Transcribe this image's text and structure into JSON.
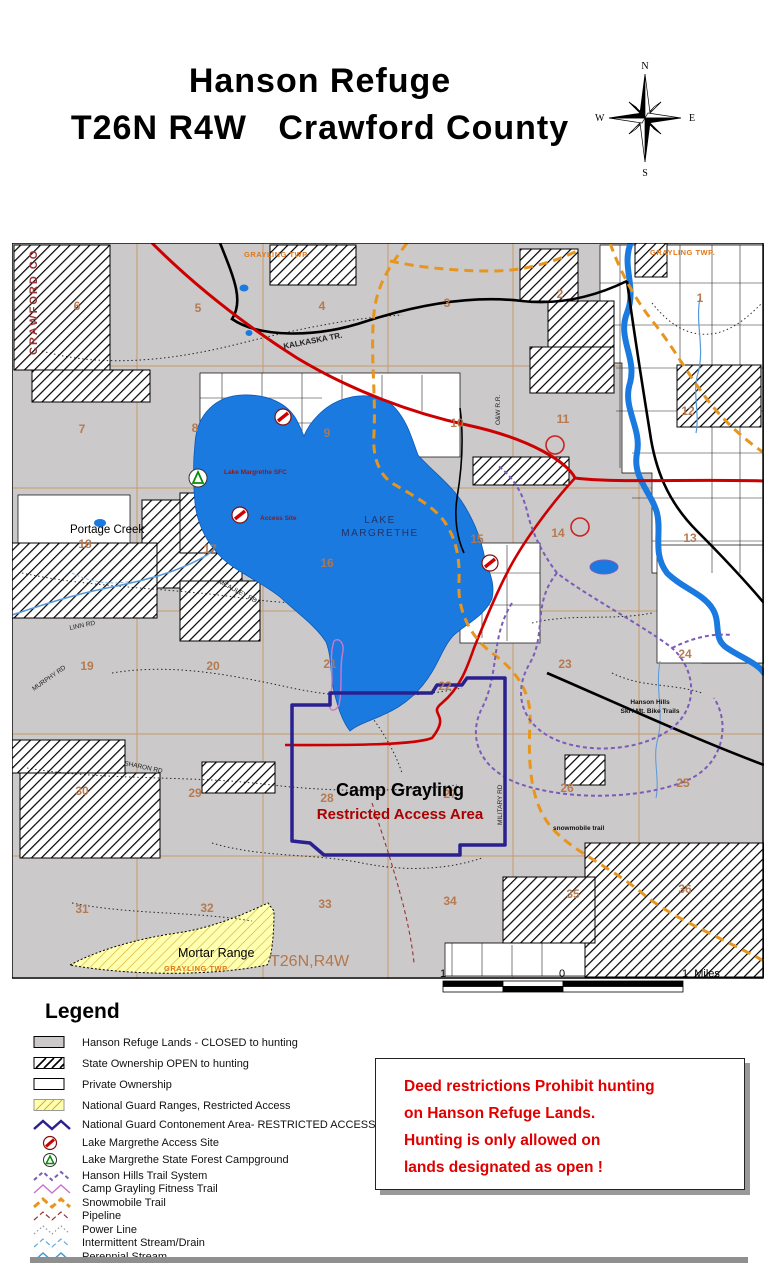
{
  "title": {
    "line1": "Hanson Refuge",
    "line2": "T26N R4W   Crawford County"
  },
  "compass": {
    "n": "N",
    "s": "S",
    "e": "E",
    "w": "W"
  },
  "map": {
    "labels": {
      "crawford_co": "CRAWFORD CO",
      "grayling_twp": "GRAYLING TWP.",
      "kalkaska_tr": "KALKASKA TR.",
      "portage_creek": "Portage Creek",
      "lake_sfc": "Lake Margrethe SFC",
      "access_site": "Access Site",
      "lake_line1": "LAKE",
      "lake_line2": "MARGRETHE",
      "mcauley_rd": "MCAULEY RD.",
      "linn_rd": "LINN RD",
      "murphy_rd": "MURPHY RD",
      "sharon_rd": "SHARON RD",
      "military_rd": "MILITARY RD",
      "ow_rr": "O&W R.R.",
      "camp_grayling": "Camp Grayling",
      "restricted": "Restricted Access Area",
      "hanson_hills_1": "Hanson Hills",
      "hanson_hills_2": "Ski / Mt. Bike Trails",
      "snowmobile": "snowmobile trail",
      "mortar_range": "Mortar Range",
      "township_range": "T26N,R4W"
    },
    "sections": [
      {
        "n": "6",
        "x": 65,
        "y": 67
      },
      {
        "n": "5",
        "x": 186,
        "y": 69
      },
      {
        "n": "4",
        "x": 310,
        "y": 67
      },
      {
        "n": "3",
        "x": 435,
        "y": 64
      },
      {
        "n": "2",
        "x": 548,
        "y": 55
      },
      {
        "n": "1",
        "x": 688,
        "y": 59
      },
      {
        "n": "7",
        "x": 70,
        "y": 190
      },
      {
        "n": "8",
        "x": 183,
        "y": 189
      },
      {
        "n": "9",
        "x": 315,
        "y": 194
      },
      {
        "n": "10",
        "x": 445,
        "y": 184
      },
      {
        "n": "11",
        "x": 551,
        "y": 180
      },
      {
        "n": "12",
        "x": 676,
        "y": 172
      },
      {
        "n": "18",
        "x": 73,
        "y": 305
      },
      {
        "n": "17",
        "x": 198,
        "y": 310
      },
      {
        "n": "16",
        "x": 315,
        "y": 324
      },
      {
        "n": "15",
        "x": 465,
        "y": 300
      },
      {
        "n": "14",
        "x": 546,
        "y": 294
      },
      {
        "n": "13",
        "x": 678,
        "y": 299
      },
      {
        "n": "19",
        "x": 75,
        "y": 427
      },
      {
        "n": "20",
        "x": 201,
        "y": 427
      },
      {
        "n": "21",
        "x": 318,
        "y": 425
      },
      {
        "n": "22",
        "x": 433,
        "y": 447
      },
      {
        "n": "23",
        "x": 553,
        "y": 425
      },
      {
        "n": "24",
        "x": 673,
        "y": 415
      },
      {
        "n": "30",
        "x": 70,
        "y": 552
      },
      {
        "n": "29",
        "x": 183,
        "y": 554
      },
      {
        "n": "28",
        "x": 315,
        "y": 559
      },
      {
        "n": "27",
        "x": 438,
        "y": 555
      },
      {
        "n": "26",
        "x": 555,
        "y": 549
      },
      {
        "n": "25",
        "x": 671,
        "y": 544
      },
      {
        "n": "31",
        "x": 70,
        "y": 670
      },
      {
        "n": "32",
        "x": 195,
        "y": 669
      },
      {
        "n": "33",
        "x": 313,
        "y": 665
      },
      {
        "n": "34",
        "x": 438,
        "y": 662
      },
      {
        "n": "35",
        "x": 561,
        "y": 655
      },
      {
        "n": "36",
        "x": 673,
        "y": 650
      }
    ]
  },
  "scalebar": {
    "left": "1",
    "zero": "0",
    "right": "1  Miles"
  },
  "legend": {
    "heading": "Legend",
    "items": [
      {
        "label": "Hanson Refuge Lands - CLOSED to hunting",
        "type": "swatch",
        "fill": "#cbc9c9"
      },
      {
        "label": "State Ownership OPEN to hunting",
        "type": "swatch-hatch",
        "fill": "#ffffff"
      },
      {
        "label": "Private Ownership",
        "type": "swatch",
        "fill": "#ffffff"
      },
      {
        "label": "National Guard Ranges, Restricted Access",
        "type": "swatch-hatch-yellow",
        "fill": "#ffffb0"
      },
      {
        "label": "National Guard Contonement Area- RESTRICTED ACCESS",
        "type": "zigzag",
        "color": "#2a2090",
        "width": 2.5
      },
      {
        "label": "Lake Margrethe Access Site",
        "type": "icon-access"
      },
      {
        "label": "Lake Margrethe State Forest Campground",
        "type": "icon-camp"
      },
      {
        "label": "Hanson Hills Trail System",
        "type": "zigzag-dash",
        "color": "#7a5cb8",
        "dash": "4,3",
        "width": 2
      },
      {
        "label": "Camp Grayling Fitness Trail",
        "type": "zigzag",
        "color": "#cc77cc",
        "width": 1.5
      },
      {
        "label": "Snowmobile Trail",
        "type": "zigzag-dash",
        "color": "#e8951d",
        "dash": "7,4",
        "width": 3
      },
      {
        "label": "Pipeline",
        "type": "zigzag-dash",
        "color": "#993333",
        "dash": "5,3",
        "width": 1.2
      },
      {
        "label": "Power Line",
        "type": "zigzag-dot",
        "color": "#999999",
        "dash": "1.5,2.5",
        "width": 1.2
      },
      {
        "label": "Intermittent Stream/Drain",
        "type": "zigzag-dash",
        "color": "#66aadd",
        "dash": "5,3",
        "width": 1.2
      },
      {
        "label": "Perennial Stream",
        "type": "zigzag",
        "color": "#4499cc",
        "width": 1.5
      }
    ]
  },
  "notice": {
    "lines": [
      "Deed restrictions Prohibit hunting",
      "on Hanson Refuge Lands.",
      "Hunting is only allowed on",
      "lands designated as open !"
    ]
  },
  "colors": {
    "refuge_gray": "#cbc9c9",
    "lake_blue": "#1a7ae0",
    "road_red": "#cc0000",
    "boundary_navy": "#2a2090",
    "trail_purple": "#7a5cb8",
    "fitness_magenta": "#cc77cc",
    "snowmobile_orange": "#e8951d",
    "range_yellow": "#ffffb0",
    "section_tan": "#b5764a",
    "township_orange": "#e07818",
    "notice_red": "#e00000"
  }
}
